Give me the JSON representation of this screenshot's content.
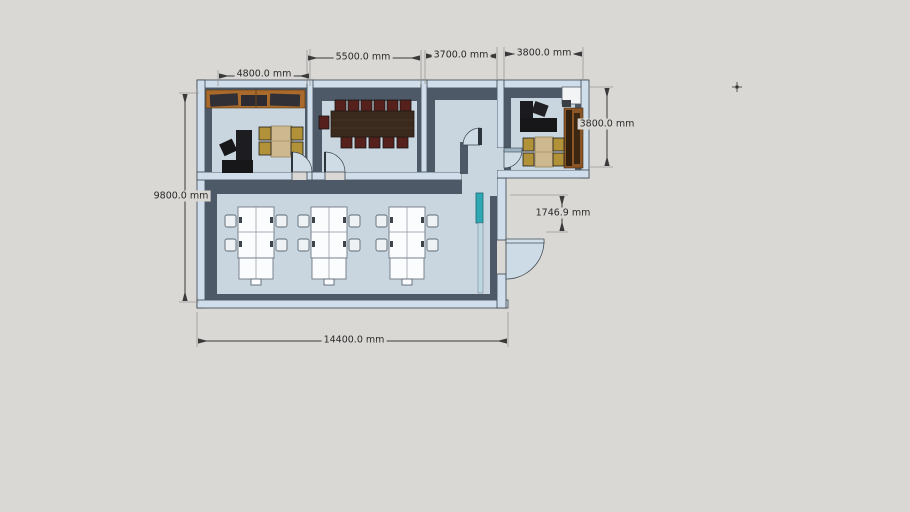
{
  "viewer": {
    "description": "Top-down axonometric view of an office floor plan model with dimension annotations",
    "background_color": "#d9d8d5",
    "units": "mm"
  },
  "palette": {
    "floor": "#c9d6e0",
    "wall_top": "#cfdeea",
    "wall_face": "#4d5966",
    "outline": "#39434d",
    "wood_counter": "#a96a2b",
    "wood_cabinet": "#8a5527",
    "conference_table": "#3a2a1e",
    "chair_red": "#56201c",
    "chair_gold": "#b29238",
    "desk_black": "#17171a",
    "white_desk": "#fbfcfe",
    "teal_door": "#2fa8b4",
    "dimension_line": "#3a3a3a"
  },
  "dims": {
    "d4800": {
      "label": "4800.0 mm",
      "value_mm": 4800.0,
      "orientation": "horizontal",
      "measures": "left room width"
    },
    "d5500": {
      "label": "5500.0 mm",
      "value_mm": 5500.0,
      "orientation": "horizontal",
      "measures": "conference room width"
    },
    "d3700": {
      "label": "3700.0 mm",
      "value_mm": 3700.0,
      "orientation": "horizontal",
      "measures": "third room width"
    },
    "d3800_top": {
      "label": "3800.0 mm",
      "value_mm": 3800.0,
      "orientation": "horizontal",
      "measures": "right room width"
    },
    "d9800": {
      "label": "9800.0 mm",
      "value_mm": 9800.0,
      "orientation": "vertical",
      "measures": "building depth"
    },
    "d3800_right": {
      "label": "3800.0 mm",
      "value_mm": 3800.0,
      "orientation": "vertical",
      "measures": "right room depth"
    },
    "d1746": {
      "label": "1746.9 mm",
      "value_mm": 1746.9,
      "orientation": "vertical",
      "measures": "offset to entrance door"
    },
    "d14400": {
      "label": "14400.0 mm",
      "value_mm": 14400.0,
      "orientation": "horizontal",
      "measures": "building width"
    }
  },
  "rooms": [
    {
      "name": "left-office",
      "furniture": [
        "wood-counter",
        "black-l-desk",
        "office-chair",
        "meeting-table",
        "4-gold-chairs"
      ]
    },
    {
      "name": "conference-room",
      "furniture": [
        "long-conference-table",
        "12-red-black-chairs"
      ]
    },
    {
      "name": "empty-room",
      "furniture": []
    },
    {
      "name": "right-office",
      "furniture": [
        "white-cabinet",
        "black-l-desk",
        "office-chair",
        "wood-bookshelf",
        "meeting-table",
        "4-gold-chairs"
      ]
    },
    {
      "name": "open-office",
      "furniture": [
        "white-desk-cluster-1",
        "white-desk-cluster-2",
        "white-desk-cluster-3",
        "12-white-chairs",
        "teal-glass-door"
      ]
    }
  ],
  "cursor": {
    "icon": "crosshair-icon",
    "x": 737,
    "y": 87
  }
}
